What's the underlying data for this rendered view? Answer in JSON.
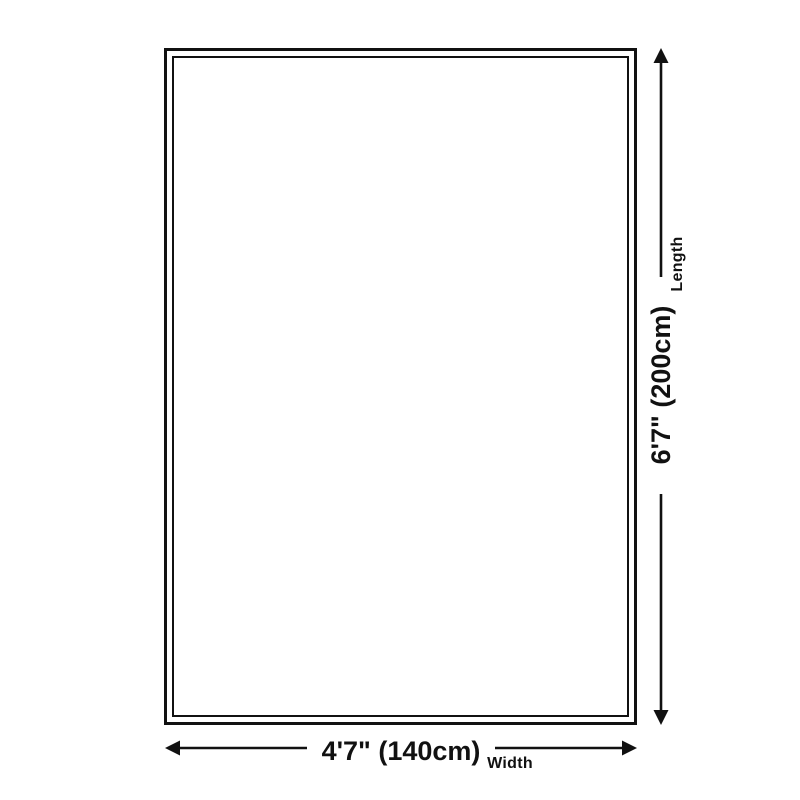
{
  "colors": {
    "line": "#111111",
    "text": "#111111",
    "bg": "#ffffff",
    "surface": "#ffffff"
  },
  "diagram": {
    "width": {
      "value": "4'7\" (140cm)",
      "label": "Width"
    },
    "length": {
      "value": "6'7\" (200cm)",
      "label": "Length"
    }
  }
}
